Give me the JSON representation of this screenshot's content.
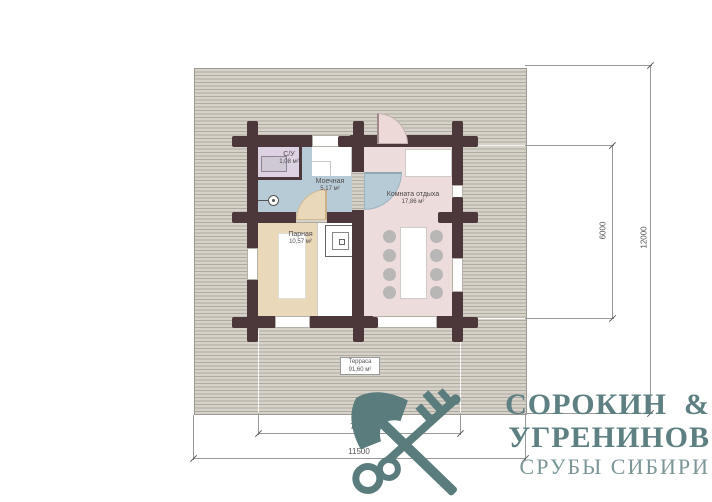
{
  "plan": {
    "rooms": [
      {
        "name": "С/У",
        "area": "1,08 м²"
      },
      {
        "name": "Моечная",
        "area": "5,17 м²"
      },
      {
        "name": "Парная",
        "area": "10,57 м²"
      },
      {
        "name": "Комната отдыха",
        "area": "17,86 м²"
      }
    ],
    "terrace": {
      "name": "Терраса",
      "area": "91,60 м²"
    }
  },
  "dimensions": {
    "building_width": "7000",
    "site_width": "11500",
    "building_height": "6000",
    "site_height": "12000"
  },
  "logo": {
    "title_line1": "СОРОКИН  &",
    "title_line2": "УГРЕНИНОВ",
    "subtitle": "СРУБЫ СИБИРИ"
  },
  "colors": {
    "wall": "#4c383b",
    "deck_stripe_light": "#d6d2ca",
    "deck_stripe_dark": "#aeaa9f",
    "room_su": "#ddd2e2",
    "room_moechnaya": "#b7cbd7",
    "room_parnaya": "#ead8ba",
    "room_komnata": "#ecdcdb",
    "chair": "#b9b7b5",
    "logo_accent": "#5a7c7d",
    "dimension_line": "#999999"
  }
}
